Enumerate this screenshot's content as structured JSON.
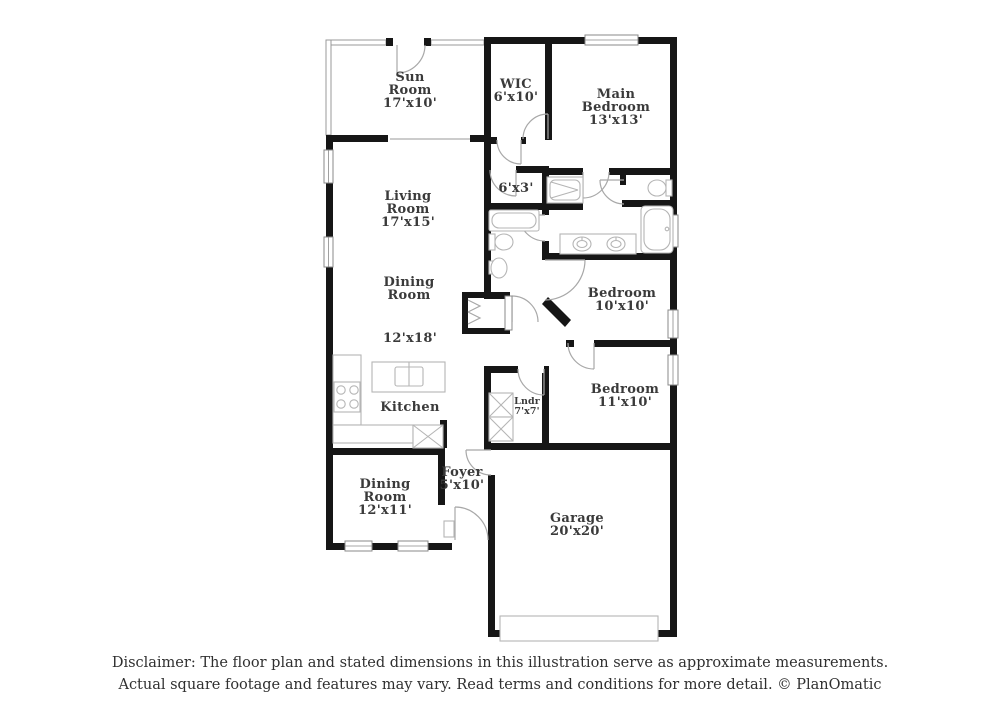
{
  "plan": {
    "colors": {
      "background": "#ffffff",
      "wall": "#161616",
      "fixture_line": "#b5b5b5",
      "door_line": "#a8a8a8",
      "label_text": "#3a3a3a",
      "footer_text": "#303030"
    },
    "rooms": {
      "sun_room": {
        "lines": [
          "Sun",
          "Room",
          "17'x10'"
        ]
      },
      "wic": {
        "lines": [
          "WIC",
          "6'x10'"
        ]
      },
      "main_bedroom": {
        "lines": [
          "Main",
          "Bedroom",
          "13'x13'"
        ]
      },
      "living_room": {
        "lines": [
          "Living",
          "Room",
          "17'x15'"
        ]
      },
      "closet_6x3": {
        "lines": [
          "6'x3'"
        ]
      },
      "dining_room": {
        "lines": [
          "Dining",
          "Room"
        ],
        "dims": "12'x18'"
      },
      "kitchen": {
        "lines": [
          "Kitchen"
        ]
      },
      "bedroom_10": {
        "lines": [
          "Bedroom",
          "10'x10'"
        ]
      },
      "bedroom_11": {
        "lines": [
          "Bedroom",
          "11'x10'"
        ]
      },
      "laundry": {
        "lines": [
          "Lndr",
          "7'x7'"
        ]
      },
      "foyer": {
        "lines": [
          "Foyer",
          "5'x10'"
        ]
      },
      "dining_room_2": {
        "lines": [
          "Dining",
          "Room",
          "12'x11'"
        ]
      },
      "garage": {
        "lines": [
          "Garage",
          "20'x20'"
        ]
      }
    },
    "fixtures": [
      "bathtub",
      "shower",
      "toilet",
      "pedestal-sink",
      "double-vanity",
      "kitchen-island-sink",
      "range-burners",
      "pantry-cabinet",
      "washer-dryer",
      "bifold-closet",
      "garage-door",
      "front-door"
    ]
  },
  "footer": {
    "line1": "Disclaimer: The floor plan and stated dimensions in this illustration serve as approximate measurements.",
    "line2": "Actual square footage and features may vary. Read terms and conditions for more detail. © PlanOmatic"
  }
}
